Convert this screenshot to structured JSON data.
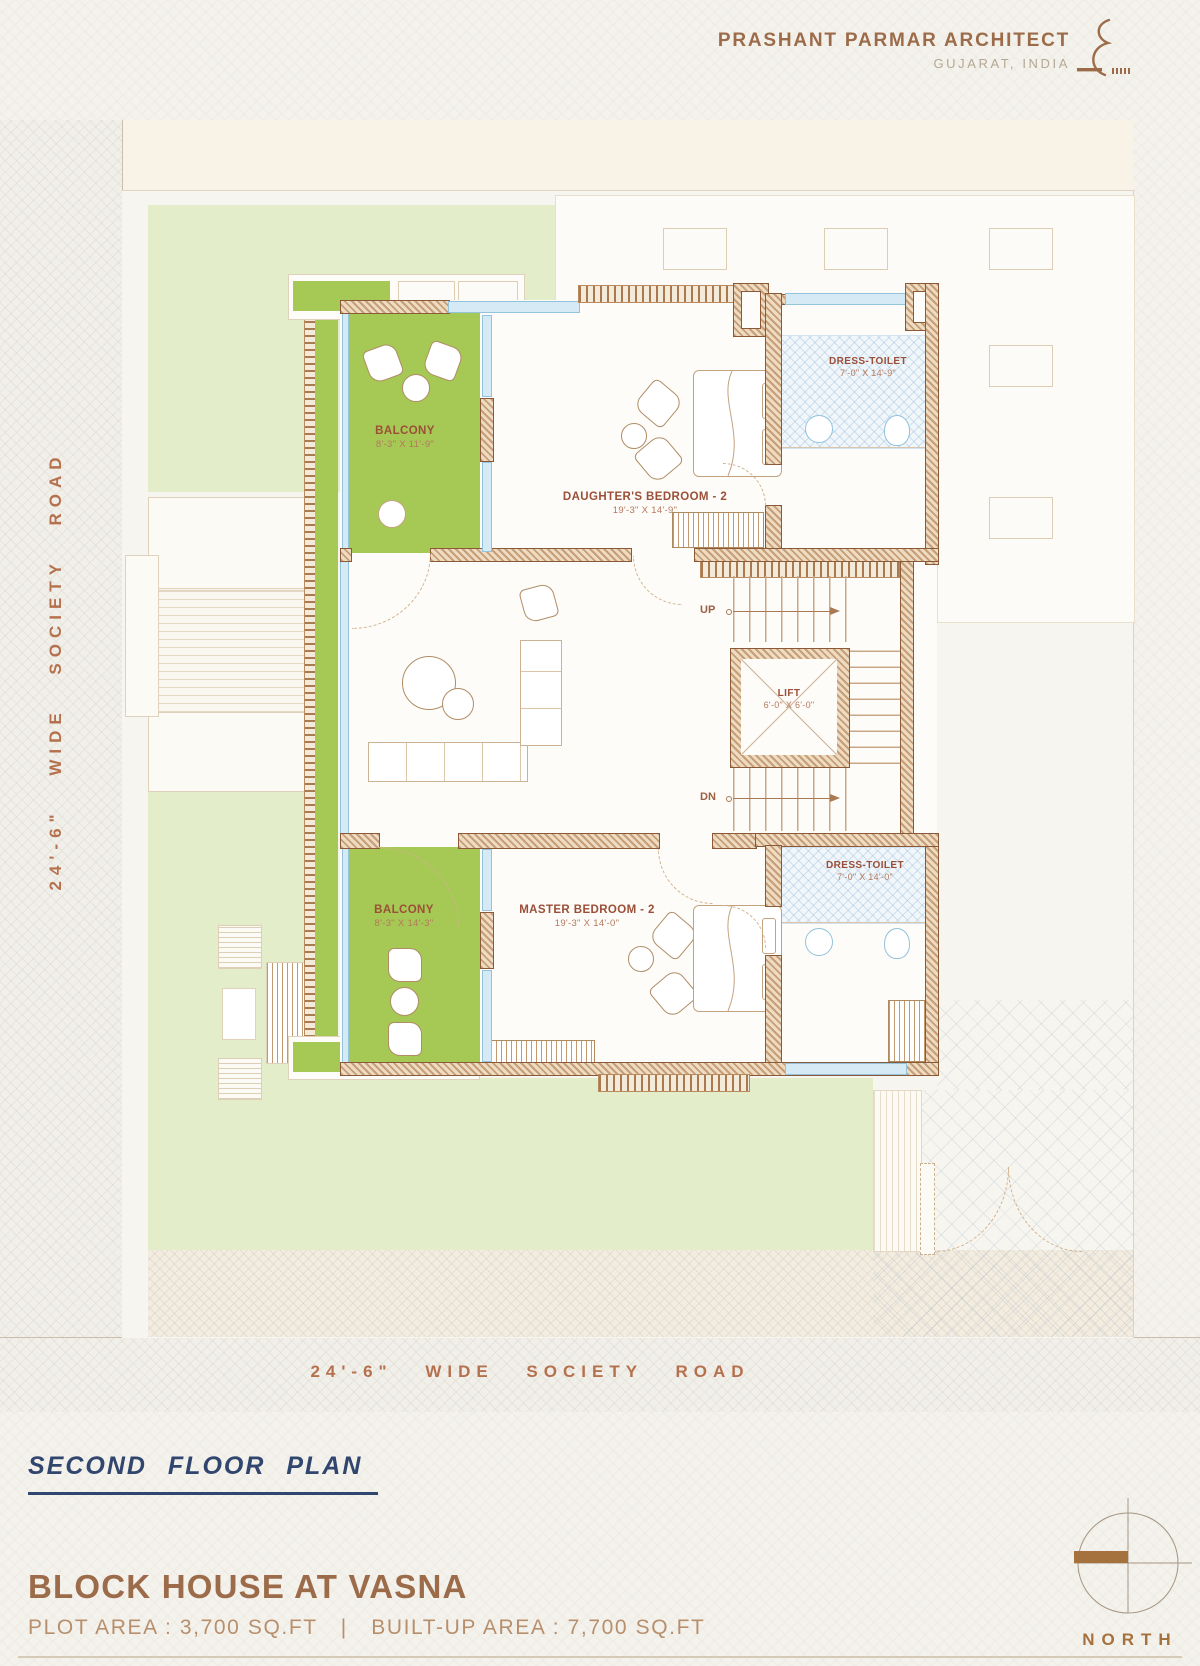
{
  "header": {
    "firm": "PRASHANT PARMAR ARCHITECT",
    "location": "GUJARAT, INDIA"
  },
  "roads": {
    "left": "24'-6\" WIDE SOCIETY ROAD",
    "bottom": "24'-6\" WIDE SOCIETY ROAD"
  },
  "plan": {
    "rooms": [
      {
        "name": "BALCONY",
        "dims": "8'-3\" X 11'-9\""
      },
      {
        "name": "DAUGHTER'S BEDROOM - 2",
        "dims": "19'-3\" X 14'-9\""
      },
      {
        "name": "DRESS-TOILET",
        "dims": "7'-0\" X 14'-9\""
      },
      {
        "name": "LIFT",
        "dims": "6'-0\" X 6'-0\""
      },
      {
        "name": "MASTER BEDROOM - 2",
        "dims": "19'-3\" X 14'-0\""
      },
      {
        "name": "DRESS-TOILET",
        "dims": "7'-0\" X 14'-0\""
      },
      {
        "name": "BALCONY",
        "dims": "8'-3\" X 14'-3\""
      }
    ],
    "stairs": {
      "up": "UP",
      "dn": "DN"
    }
  },
  "footer": {
    "plan_title": "SECOND  FLOOR  PLAN",
    "project_title": "BLOCK HOUSE AT VASNA",
    "plot_area": "PLOT AREA : 3,700 SQ.FT",
    "divider": "|",
    "built_up_area": "BUILT-UP AREA : 7,700 SQ.FT",
    "north": "NORTH"
  },
  "colors": {
    "accent_brown": "#9c6b4a",
    "navy": "#31466e",
    "terracotta": "#b5714e",
    "balcony_green": "#a6c854",
    "garden_green": "#e4edc9"
  }
}
